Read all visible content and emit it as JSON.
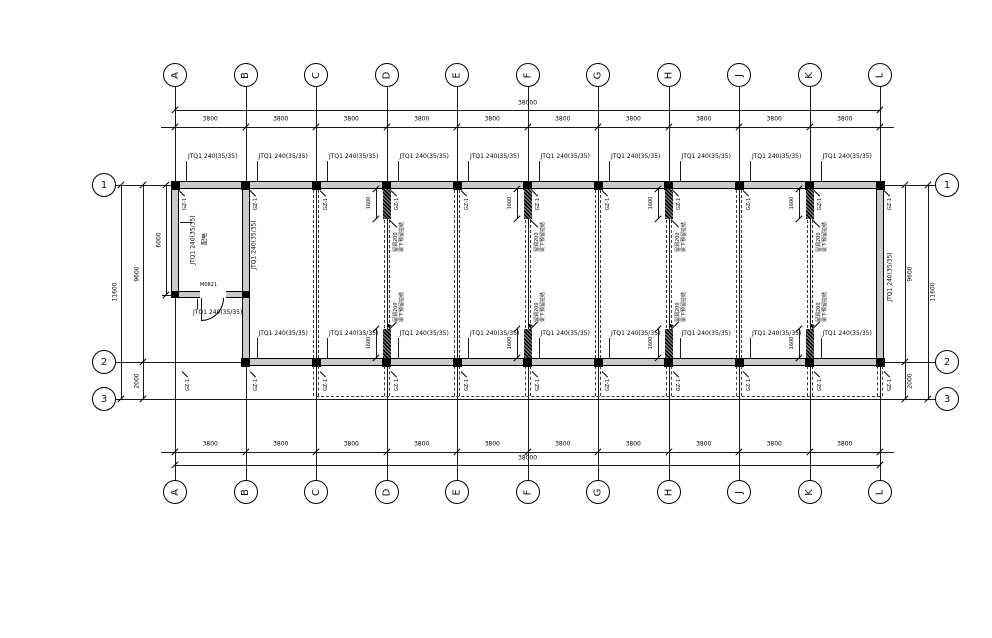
{
  "grid": {
    "letters": [
      "A",
      "B",
      "C",
      "D",
      "E",
      "F",
      "G",
      "H",
      "J",
      "K",
      "L"
    ],
    "rows": [
      "1",
      "2",
      "3"
    ],
    "partition_grids": [
      "C",
      "D",
      "E",
      "F",
      "G",
      "H",
      "J",
      "K"
    ],
    "hatched_grids": [
      "D",
      "F",
      "H",
      "K"
    ]
  },
  "dimensions": {
    "total_width": "38000",
    "bay_width": "3800",
    "overall_depth": "11600",
    "grid1_to_grid2": "9600",
    "room_depth": "6000",
    "grid2_to_grid3": "2000",
    "stub_length": "1600"
  },
  "tags": {
    "exterior_wall": "JTQ1 240(35/35)",
    "column": "GZ-1",
    "door": "M0821",
    "room_name": "配电",
    "leader_note_line1": "留洞200",
    "leader_note_line2": "梁下预留拉结"
  },
  "colors": {
    "line": "#1a1a1a",
    "wall_fill": "#c9c9c9",
    "background": "#ffffff"
  }
}
